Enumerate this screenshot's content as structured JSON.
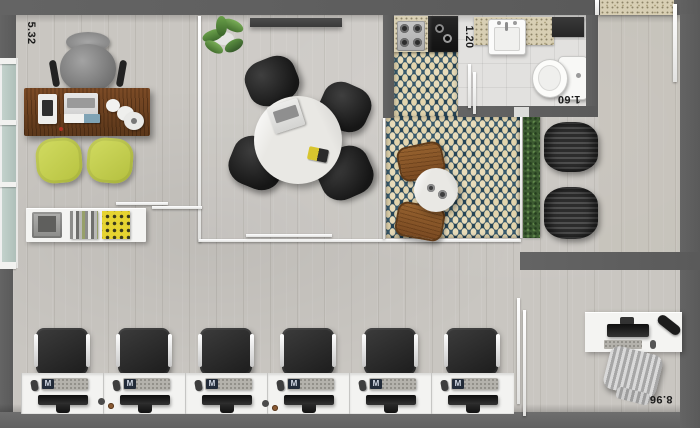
{
  "plan": {
    "dimension_labels": {
      "executive_office_width": "5.32",
      "kitchen_width": "1.20",
      "bathroom_width": "1.60",
      "open_office_length": "8.96"
    },
    "workstation_row": {
      "count": 6,
      "keyboard_badge": "M"
    },
    "furniture_counts": {
      "workstations": 6,
      "meeting_chairs": 4,
      "executive_guest_chairs": 2,
      "cafe_chairs": 2,
      "waiting_poufs": 2
    },
    "colors": {
      "wall_gray": "#5e5e5e",
      "floor_gray": "#c9c6c1",
      "rug_teal": "#2d5063",
      "rug_cream": "#e8dcba",
      "executive_desk_wood": "#6e4120",
      "guest_chair_yellow": "#c9d455",
      "hedge_green": "#3c5a31",
      "counter_granite": "#d8cfb4",
      "furniture_white": "#f4f4f2",
      "chair_black": "#262626"
    }
  }
}
